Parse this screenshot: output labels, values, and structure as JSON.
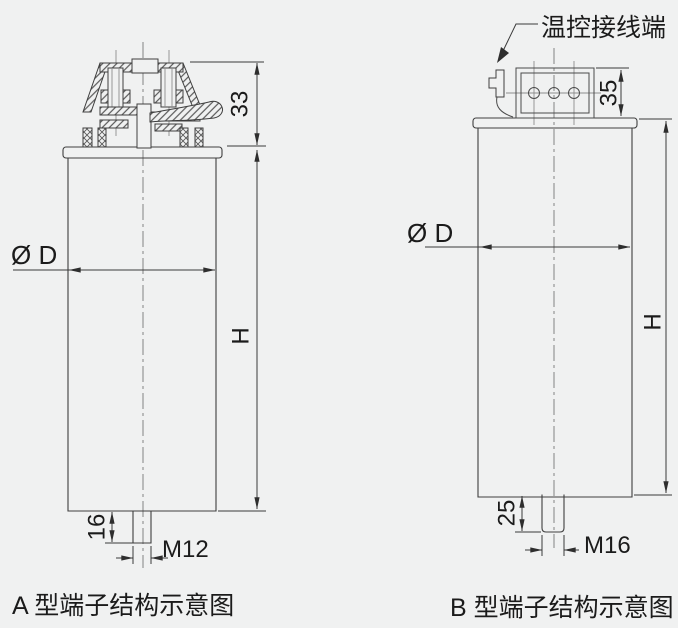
{
  "page": {
    "background_color": "#f0f1f1",
    "line_color": "#3f3f3f",
    "text_color": "#1b1b1b"
  },
  "figure_a": {
    "caption": "A 型端子结构示意图",
    "dim_terminal_height": "33",
    "dim_diameter": "Ø D",
    "dim_height": "H",
    "dim_stud_length": "16",
    "dim_thread": "M12"
  },
  "figure_b": {
    "caption": "B 型端子结构示意图",
    "annotation_label": "温控接线端",
    "dim_terminal_height": "35",
    "dim_diameter": "Ø D",
    "dim_height": "H",
    "dim_stud_length": "25",
    "dim_thread": "M16"
  }
}
